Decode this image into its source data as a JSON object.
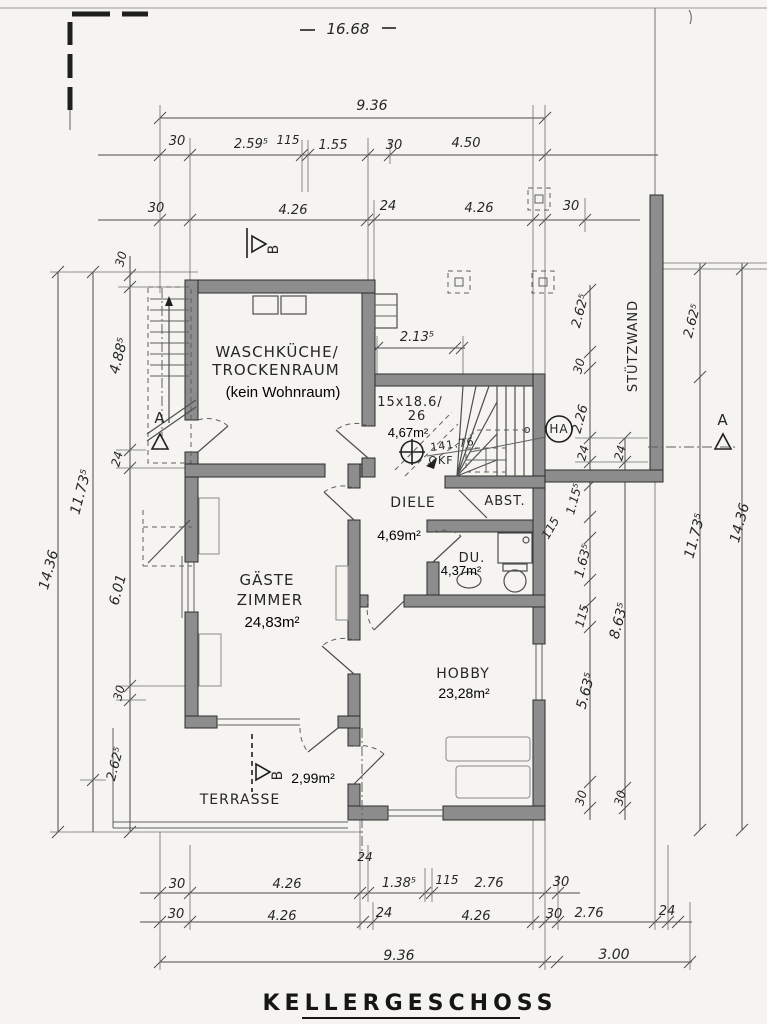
{
  "colors": {
    "paper": "#f5f4f0",
    "wall_fill": "#8d8d8d",
    "ink": "#262626",
    "dim_line": "#4d4d4d"
  },
  "drawing": {
    "labels": [
      {
        "t": "16.68",
        "x": 348,
        "y": 34,
        "s": 15,
        "n": "dim-overall-width"
      },
      {
        "t": "9.36",
        "x": 372,
        "y": 110,
        "s": 14
      },
      {
        "t": "30",
        "x": 177,
        "y": 145
      },
      {
        "t": "2.59⁵",
        "x": 251,
        "y": 148
      },
      {
        "t": "115",
        "x": 288,
        "y": 144,
        "s": 12
      },
      {
        "t": "1.55",
        "x": 333,
        "y": 149
      },
      {
        "t": "30",
        "x": 394,
        "y": 149
      },
      {
        "t": "4.50",
        "x": 466,
        "y": 147
      },
      {
        "t": "30",
        "x": 156,
        "y": 212
      },
      {
        "t": "4.26",
        "x": 293,
        "y": 214
      },
      {
        "t": "24",
        "x": 388,
        "y": 210
      },
      {
        "t": "4.26",
        "x": 479,
        "y": 212
      },
      {
        "t": "30",
        "x": 571,
        "y": 210
      },
      {
        "t": "B",
        "x": 278,
        "y": 249,
        "r": -90,
        "s": 14,
        "f": "hand",
        "n": "section-b-top-label"
      },
      {
        "t": "30",
        "x": 125,
        "y": 260,
        "r": -75,
        "s": 12
      },
      {
        "t": "4.88⁵",
        "x": 123,
        "y": 357,
        "r": -75,
        "s": 14
      },
      {
        "t": "24",
        "x": 121,
        "y": 460,
        "r": -75,
        "s": 12
      },
      {
        "t": "11.73⁵",
        "x": 85,
        "y": 493,
        "r": -75,
        "s": 14
      },
      {
        "t": "14.36",
        "x": 53,
        "y": 571,
        "r": -75,
        "s": 14
      },
      {
        "t": "6.01",
        "x": 122,
        "y": 591,
        "r": -75,
        "s": 14
      },
      {
        "t": "30",
        "x": 123,
        "y": 694,
        "r": -75,
        "s": 12
      },
      {
        "t": "2.62⁵",
        "x": 119,
        "y": 765,
        "r": -75,
        "s": 13
      },
      {
        "t": "A",
        "x": 160,
        "y": 423,
        "s": 15,
        "f": "hand",
        "n": "section-a-left-label"
      },
      {
        "t": "2.62⁵",
        "x": 584,
        "y": 312,
        "r": -75,
        "s": 13
      },
      {
        "t": "30",
        "x": 583,
        "y": 367,
        "r": -75,
        "s": 12
      },
      {
        "t": "2.26",
        "x": 584,
        "y": 420,
        "r": -75,
        "s": 13
      },
      {
        "t": "24",
        "x": 587,
        "y": 454,
        "r": -75,
        "s": 12
      },
      {
        "t": "24",
        "x": 624,
        "y": 454,
        "r": -75,
        "s": 12
      },
      {
        "t": "STÜTZWAND",
        "x": 637,
        "y": 346,
        "r": -90,
        "s": 13,
        "f": "hand",
        "n": "stuetzwand-label"
      },
      {
        "t": "2.62⁵",
        "x": 696,
        "y": 322,
        "r": -75,
        "s": 13
      },
      {
        "t": "11.73⁵",
        "x": 699,
        "y": 537,
        "r": -75,
        "s": 14
      },
      {
        "t": "14.36",
        "x": 744,
        "y": 524,
        "r": -75,
        "s": 14
      },
      {
        "t": "A",
        "x": 723,
        "y": 425,
        "s": 15,
        "f": "hand",
        "n": "section-a-right-label"
      },
      {
        "t": "1.15⁵",
        "x": 578,
        "y": 500,
        "r": -75,
        "s": 12
      },
      {
        "t": "115",
        "x": 554,
        "y": 530,
        "r": -60,
        "s": 12
      },
      {
        "t": "1.63⁵",
        "x": 587,
        "y": 562,
        "r": -75,
        "s": 13
      },
      {
        "t": "115",
        "x": 586,
        "y": 617,
        "r": -75,
        "s": 12
      },
      {
        "t": "8.63⁵",
        "x": 623,
        "y": 622,
        "r": -75,
        "s": 14
      },
      {
        "t": "5.63⁵",
        "x": 590,
        "y": 692,
        "r": -75,
        "s": 14
      },
      {
        "t": "30",
        "x": 585,
        "y": 799,
        "r": -75,
        "s": 12
      },
      {
        "t": "30",
        "x": 624,
        "y": 799,
        "r": -75,
        "s": 12
      },
      {
        "t": "WASCHKÜCHE/",
        "x": 277,
        "y": 357,
        "s": 15,
        "f": "hand",
        "n": "room-waschkueche-line1"
      },
      {
        "t": "TROCKENRAUM",
        "x": 276,
        "y": 375,
        "s": 15,
        "f": "hand",
        "n": "room-waschkueche-line2"
      },
      {
        "t": "(kein Wohnraum)",
        "x": 283,
        "y": 397,
        "s": 15,
        "f": "print",
        "n": "room-waschkueche-note"
      },
      {
        "t": "2.13⁵",
        "x": 417,
        "y": 341
      },
      {
        "t": "15x18.6/",
        "x": 410,
        "y": 406,
        "s": 13,
        "f": "hand",
        "n": "stair-spec-line1"
      },
      {
        "t": "26",
        "x": 417,
        "y": 420,
        "s": 13,
        "f": "hand",
        "n": "stair-spec-line2"
      },
      {
        "t": "4,67m²",
        "x": 408,
        "y": 437,
        "s": 13,
        "f": "print",
        "n": "stair-area"
      },
      {
        "t": "141.76",
        "x": 453,
        "y": 448,
        "r": -8,
        "s": 11,
        "f": "hand",
        "n": "stair-level-value"
      },
      {
        "t": "OKF",
        "x": 441,
        "y": 464,
        "s": 11,
        "f": "hand",
        "n": "stair-level-label"
      },
      {
        "t": "HA",
        "x": 559,
        "y": 433,
        "s": 12,
        "f": "hand",
        "n": "ha-label"
      },
      {
        "t": "DIELE",
        "x": 413,
        "y": 507,
        "s": 14,
        "f": "hand",
        "n": "room-diele-name"
      },
      {
        "t": "4,69m²",
        "x": 399,
        "y": 540,
        "s": 14,
        "f": "print",
        "n": "room-diele-area"
      },
      {
        "t": "ABST.",
        "x": 505,
        "y": 505,
        "s": 13,
        "f": "hand",
        "n": "room-abst-name"
      },
      {
        "t": "DU.",
        "x": 472,
        "y": 562,
        "s": 13,
        "f": "hand",
        "n": "room-du-name"
      },
      {
        "t": "4,37m²",
        "x": 461,
        "y": 575,
        "s": 13,
        "f": "print",
        "n": "room-du-area"
      },
      {
        "t": "GÄSTE",
        "x": 267,
        "y": 585,
        "s": 15,
        "f": "hand",
        "n": "room-gaeste-line1"
      },
      {
        "t": "ZIMMER",
        "x": 270,
        "y": 605,
        "s": 15,
        "f": "hand",
        "n": "room-gaeste-line2"
      },
      {
        "t": "24,83m²",
        "x": 272,
        "y": 627,
        "s": 15,
        "f": "print",
        "n": "room-gaeste-area"
      },
      {
        "t": "HOBBY",
        "x": 463,
        "y": 678,
        "s": 14,
        "f": "hand",
        "n": "room-hobby-name"
      },
      {
        "t": "23,28m²",
        "x": 464,
        "y": 698,
        "s": 14,
        "f": "print",
        "n": "room-hobby-area"
      },
      {
        "t": "2,99m²",
        "x": 313,
        "y": 783,
        "s": 14,
        "f": "print",
        "n": "terrasse-area"
      },
      {
        "t": "B",
        "x": 282,
        "y": 775,
        "r": -90,
        "s": 14,
        "f": "hand",
        "n": "section-b-bottom-label"
      },
      {
        "t": "TERRASSE",
        "x": 240,
        "y": 804,
        "s": 14,
        "f": "hand",
        "n": "room-terrasse-name"
      },
      {
        "t": "24",
        "x": 365,
        "y": 861,
        "s": 12
      },
      {
        "t": "30",
        "x": 177,
        "y": 888
      },
      {
        "t": "4.26",
        "x": 287,
        "y": 888
      },
      {
        "t": "1.38⁵",
        "x": 399,
        "y": 887
      },
      {
        "t": "115",
        "x": 447,
        "y": 884,
        "s": 12
      },
      {
        "t": "2.76",
        "x": 489,
        "y": 887
      },
      {
        "t": "30",
        "x": 561,
        "y": 886
      },
      {
        "t": "30",
        "x": 176,
        "y": 918
      },
      {
        "t": "4.26",
        "x": 282,
        "y": 920
      },
      {
        "t": "24",
        "x": 384,
        "y": 917
      },
      {
        "t": "4.26",
        "x": 476,
        "y": 920
      },
      {
        "t": "30",
        "x": 554,
        "y": 918
      },
      {
        "t": "2.76",
        "x": 589,
        "y": 917
      },
      {
        "t": "24",
        "x": 667,
        "y": 915
      },
      {
        "t": "9.36",
        "x": 399,
        "y": 960,
        "s": 14
      },
      {
        "t": "3.00",
        "x": 614,
        "y": 959,
        "s": 14
      },
      {
        "t": "KELLERGESCHOSS",
        "x": 410,
        "y": 1010,
        "s": 22,
        "f": "title",
        "n": "floor-title"
      }
    ]
  }
}
